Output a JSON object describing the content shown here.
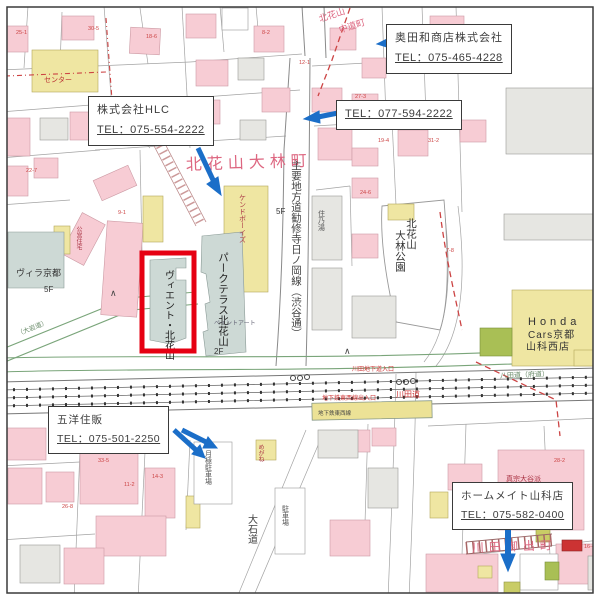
{
  "page": {
    "width": 600,
    "height": 600,
    "background": "#ffffff",
    "frame_color": "#3a3a3a"
  },
  "annotations": {
    "okudawa": {
      "name": "奥田和商店株式会社",
      "tel": "TEL：075-465-4228"
    },
    "hlc": {
      "name": "株式会社HLC",
      "tel": "TEL：075-554-2222"
    },
    "tel_only": {
      "tel": "TEL：077-594-2222"
    },
    "goyo": {
      "name": "五洋住販",
      "tel": "TEL：075-501-2250"
    },
    "homemate": {
      "name": "ホームメイト山科店",
      "tel": "TEL：075-582-0400"
    }
  },
  "map": {
    "highlight_color": "#e60012",
    "arrow_color": "#1b6ec8",
    "town_color": "#dd6680",
    "labels": [
      {
        "text": "北花山大林町",
        "x": 186,
        "y": 170,
        "size": 16,
        "color": "#dd6680",
        "spacing": 5,
        "rotate": -2
      },
      {
        "text": "川田御出町",
        "x": 472,
        "y": 552,
        "size": 12,
        "color": "#dd6680",
        "spacing": 5,
        "rotate": -2
      },
      {
        "text": "北花山",
        "x": 320,
        "y": 22,
        "size": 9,
        "color": "#dd6680",
        "rotate": -18
      },
      {
        "text": "中道町",
        "x": 340,
        "y": 33,
        "size": 9,
        "color": "#dd6680",
        "rotate": -18
      },
      {
        "text": "主要地方道勧修寺日ノ岡線（渋谷通）",
        "x": 296,
        "y": 160,
        "size": 10.5,
        "color": "#444444",
        "vertical": true
      },
      {
        "text": "パークテラス北花山",
        "x": 223,
        "y": 252,
        "size": 10.5,
        "color": "#222222",
        "vertical": true
      },
      {
        "text": "ヴィエント・北花山",
        "x": 168,
        "y": 270,
        "size": 10,
        "color": "#222222",
        "vertical": true
      },
      {
        "text": "北花山",
        "x": 411,
        "y": 218,
        "size": 10.5,
        "color": "#333333",
        "vertical": true
      },
      {
        "text": "大林公園",
        "x": 400,
        "y": 230,
        "size": 10.5,
        "color": "#333333",
        "vertical": true
      },
      {
        "text": "Honda",
        "x": 528,
        "y": 325,
        "size": 11,
        "color": "#333333",
        "spacing": 4
      },
      {
        "text": "Cars京都",
        "x": 528,
        "y": 338,
        "size": 10,
        "color": "#333333",
        "spacing": 1
      },
      {
        "text": "山科西店",
        "x": 526,
        "y": 350,
        "size": 10,
        "color": "#333333",
        "spacing": 1
      },
      {
        "text": "ヴィラ京都",
        "x": 16,
        "y": 276,
        "size": 9,
        "color": "#333333"
      },
      {
        "text": "5F",
        "x": 44,
        "y": 292,
        "size": 8,
        "color": "#333333"
      },
      {
        "text": "2F",
        "x": 214,
        "y": 354,
        "size": 8,
        "color": "#333333"
      },
      {
        "text": "5F",
        "x": 276,
        "y": 214,
        "size": 8,
        "color": "#333333"
      },
      {
        "text": "川田道",
        "x": 396,
        "y": 397,
        "size": 8,
        "color": "#cc3333"
      },
      {
        "text": "川田地下道入口",
        "x": 352,
        "y": 371,
        "size": 6,
        "color": "#cc3333"
      },
      {
        "text": "地下鉄東西線出入口",
        "x": 322,
        "y": 400,
        "size": 6,
        "color": "#cc3333"
      },
      {
        "text": "地下鉄東西線",
        "x": 318,
        "y": 415,
        "size": 5.5,
        "color": "#444444"
      },
      {
        "text": "八田道（府道）",
        "x": 500,
        "y": 378,
        "size": 7,
        "color": "#668866",
        "rotate": -2
      },
      {
        "text": "大石道",
        "x": 251,
        "y": 514,
        "size": 10,
        "color": "#444444",
        "vertical": true
      },
      {
        "text": "月極駐車場",
        "x": 208,
        "y": 450,
        "size": 7,
        "color": "#555555",
        "vertical": true
      },
      {
        "text": "駐車場",
        "x": 285,
        "y": 505,
        "size": 7,
        "color": "#555555",
        "vertical": true
      },
      {
        "text": "真宗大谷派",
        "x": 506,
        "y": 481,
        "size": 7,
        "color": "#aa3344"
      },
      {
        "text": "ケンドボーイズ",
        "x": 242,
        "y": 194,
        "size": 7,
        "color": "#aa3344",
        "vertical": true
      },
      {
        "text": "住乃湯",
        "x": 321,
        "y": 210,
        "size": 7,
        "color": "#555555",
        "vertical": true
      },
      {
        "text": "センター",
        "x": 44,
        "y": 82,
        "size": 7,
        "color": "#bb3333"
      },
      {
        "text": "公営住宅",
        "x": 78,
        "y": 226,
        "size": 6,
        "color": "#aa3344",
        "vertical": true
      },
      {
        "text": "めがね",
        "x": 260,
        "y": 444,
        "size": 6,
        "color": "#aa3344",
        "vertical": true
      },
      {
        "text": "ペイントアート",
        "x": 214,
        "y": 325,
        "size": 6,
        "color": "#666677"
      },
      {
        "text": "（大岩道）",
        "x": 18,
        "y": 336,
        "size": 6.5,
        "color": "#668866",
        "rotate": -22
      },
      {
        "text": "∧",
        "x": 110,
        "y": 296,
        "size": 9,
        "color": "#444444"
      },
      {
        "text": "∧",
        "x": 344,
        "y": 354,
        "size": 9,
        "color": "#444444"
      }
    ],
    "plot_numbers": [
      {
        "text": "30-5",
        "x": 88,
        "y": 30
      },
      {
        "text": "25-1",
        "x": 16,
        "y": 34
      },
      {
        "text": "18-6",
        "x": 146,
        "y": 38
      },
      {
        "text": "8-2",
        "x": 262,
        "y": 34
      },
      {
        "text": "12-1",
        "x": 299,
        "y": 64
      },
      {
        "text": "27-3",
        "x": 355,
        "y": 98
      },
      {
        "text": "19-4",
        "x": 378,
        "y": 142
      },
      {
        "text": "31-2",
        "x": 428,
        "y": 142
      },
      {
        "text": "24-6",
        "x": 360,
        "y": 194
      },
      {
        "text": "7-8",
        "x": 446,
        "y": 252
      },
      {
        "text": "15-3",
        "x": 88,
        "y": 128
      },
      {
        "text": "22-7",
        "x": 26,
        "y": 172
      },
      {
        "text": "9-1",
        "x": 118,
        "y": 214
      },
      {
        "text": "28-2",
        "x": 554,
        "y": 462
      },
      {
        "text": "16-4",
        "x": 584,
        "y": 548
      },
      {
        "text": "33-5",
        "x": 98,
        "y": 462
      },
      {
        "text": "11-2",
        "x": 124,
        "y": 486
      },
      {
        "text": "26-8",
        "x": 62,
        "y": 508
      },
      {
        "text": "14-3",
        "x": 152,
        "y": 478
      },
      {
        "text": "21-6",
        "x": 546,
        "y": 508
      }
    ]
  }
}
